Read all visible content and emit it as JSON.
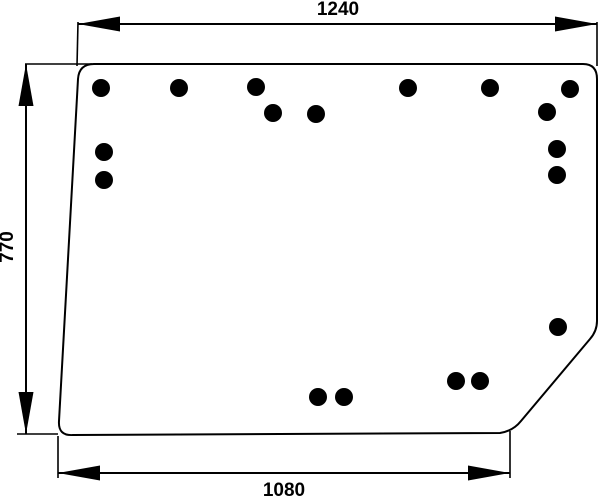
{
  "title": "Glass panel technical drawing",
  "chart_data": {
    "type": "table",
    "title": "Panel dimensions (mm)",
    "dimensions": [
      {
        "edge": "top-width",
        "value_mm": 1240
      },
      {
        "edge": "left-height",
        "value_mm": 770
      },
      {
        "edge": "bottom-width",
        "value_mm": 1080
      }
    ],
    "hole_count": 18
  },
  "drawing": {
    "canvas": {
      "width": 600,
      "height": 498,
      "background": "#ffffff",
      "stroke_color": "#000000",
      "stroke_width": 2
    },
    "panel": {
      "outline_path": "M 94,64 L 583,64 Q 597,64 597,79 L 597,321 Q 597,331 590,339 L 521,421 Q 513,431 500,433 L 73,435 Q 58,436 59,421 L 78,79 Q 79,64 94,64 Z",
      "fill": "#ffffff"
    },
    "holes": {
      "radius": 9,
      "color": "#000000",
      "centers": [
        [
          101,
          88
        ],
        [
          179,
          88
        ],
        [
          256,
          87
        ],
        [
          273,
          113
        ],
        [
          316,
          114
        ],
        [
          408,
          88
        ],
        [
          490,
          88
        ],
        [
          570,
          89
        ],
        [
          547,
          112
        ],
        [
          557,
          149
        ],
        [
          557,
          175
        ],
        [
          104,
          152
        ],
        [
          104,
          180
        ],
        [
          558,
          327
        ],
        [
          456,
          381
        ],
        [
          480,
          381
        ],
        [
          318,
          397
        ],
        [
          344,
          397
        ]
      ]
    },
    "arrow": {
      "length": 42,
      "half_width": 7.5
    },
    "dimensions": [
      {
        "name": "dimension-top-width",
        "label": "1240",
        "type": "horizontal",
        "x1": 78,
        "x2": 597,
        "y": 24,
        "label_x": 338,
        "label_y": 15,
        "ext": [
          [
            78,
            22,
            77,
            66
          ],
          [
            597,
            22,
            597,
            66
          ]
        ]
      },
      {
        "name": "dimension-left-height",
        "label": "770",
        "type": "vertical",
        "x": 26,
        "y1": 64,
        "y2": 434,
        "label_x": 13,
        "label_y": 247,
        "ext": [
          [
            25,
            64,
            92,
            64
          ],
          [
            17,
            434,
            58,
            434
          ]
        ]
      },
      {
        "name": "dimension-bottom-width",
        "label": "1080",
        "type": "horizontal",
        "x1": 58,
        "x2": 510,
        "y": 473,
        "label_x": 284,
        "label_y": 496,
        "ext": [
          [
            58,
            436,
            58,
            478
          ],
          [
            510,
            431,
            510,
            478
          ]
        ]
      }
    ]
  }
}
